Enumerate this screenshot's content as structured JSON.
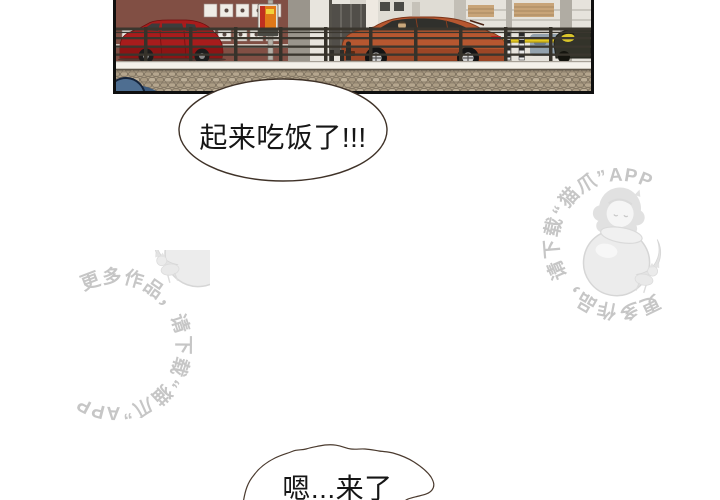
{
  "page": {
    "width": 720,
    "height": 500,
    "background": "#ffffff"
  },
  "panel": {
    "description": "Street scene: red hatchback and orange coupe parked behind a dark metal railing on a cobblestone wall, brick and modern buildings behind, yellow barrier arm and dark car at right, blue wheel in foreground",
    "colors": {
      "border": "#0f0f0f",
      "backdrop": "#d9d5cd",
      "brick_building": "#7c4a40",
      "modern_wall": "#e7e4dd",
      "red_car": "#a81c1c",
      "orange_car": "#b65730",
      "fence": "#3a362e",
      "ledge": "#f4f1ea",
      "stone_wall": "#b0a188",
      "barrier_yellow": "#e3c822",
      "blue_wheel": "#4e6e91",
      "vending_sign": "#e07818"
    }
  },
  "bubbles": [
    {
      "id": "top",
      "text": "起来吃饭了!!!"
    },
    {
      "id": "bottom",
      "text": "嗯...来了"
    }
  ],
  "watermark": {
    "text": "更多作品，请下载“猫爪”APP",
    "color": "#c6c6c6",
    "illustration": "girl-hugging-yarn-ball-with-cat"
  }
}
